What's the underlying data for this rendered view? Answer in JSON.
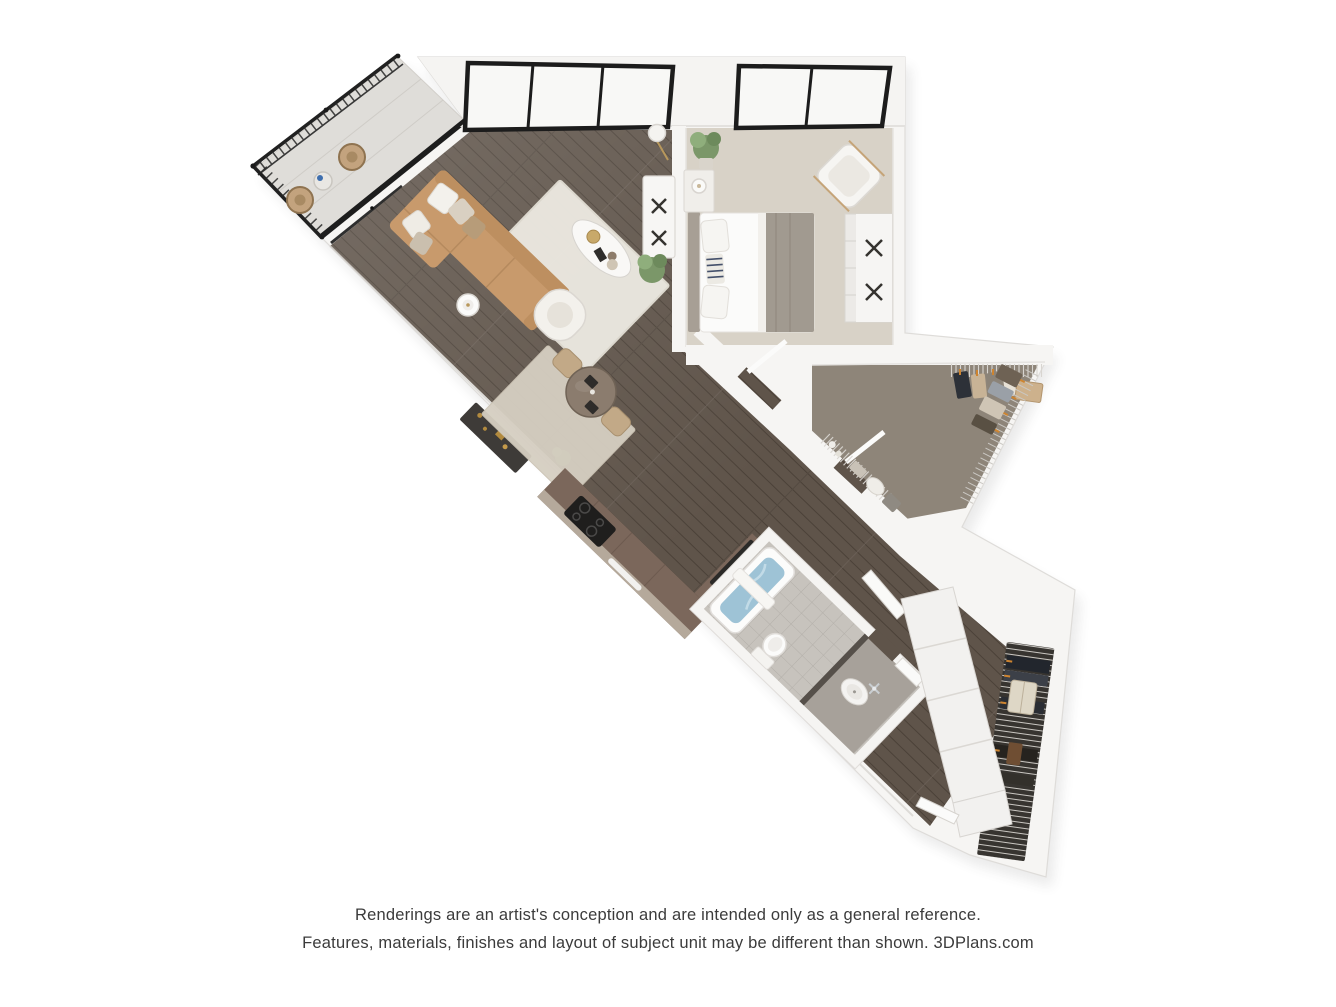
{
  "page": {
    "background": "#ffffff"
  },
  "disclaimer": {
    "line1": "Renderings are an artist's conception and are intended only as a general reference.",
    "line2": "Features, materials, finishes and layout of subject unit may be different than shown. 3DPlans.com"
  },
  "branding": {
    "site": "3DPlans.com"
  },
  "floorplan": {
    "view": "3d-top-down-rendering",
    "rotation_degrees": 44,
    "rooms": [
      "balcony",
      "living-room",
      "dining-area",
      "kitchen",
      "entry-hall",
      "bedroom",
      "walk-in-closet",
      "bathroom",
      "hall-closet"
    ],
    "furniture": [
      "wicker-chairs",
      "patio-table",
      "sofa",
      "area-rug",
      "coffee-table",
      "accent-chair",
      "side-table",
      "floor-lamp",
      "media-console",
      "sideboard",
      "plants",
      "dining-table",
      "dining-chairs",
      "cooktop",
      "oven",
      "refrigerator",
      "kettle",
      "bed",
      "nightstand",
      "table-lamp",
      "lounge-chair",
      "dresser",
      "bathtub",
      "toilet",
      "vanity-sink",
      "wire-shelving",
      "hanging-clothes",
      "bifold-doors",
      "garment-bag"
    ],
    "colors": {
      "wall": "#f6f5f3",
      "wall_edge": "#dedcd9",
      "wood_floor": "#5f544a",
      "wood_seam": "#4b4138",
      "bedroom_carpet": "#d8d2c7",
      "closet_carpet": "#8e8579",
      "balcony_floor": "#dfddd9",
      "sofa": "#c89a6c",
      "area_rug": "#ebe8e0",
      "dining_rug": "#d6cfc2",
      "counter": "#7b675b",
      "counter_speckle": "#b5a99b",
      "bath_tile": "#c7c3bd",
      "tub_water": "#9ec3d6",
      "vanity_granite": "#a7a19a",
      "railing": "#222222",
      "window_frame": "#1c1c1c",
      "hanger_accent": "#cd8430",
      "text": "#3b3b3b"
    }
  }
}
